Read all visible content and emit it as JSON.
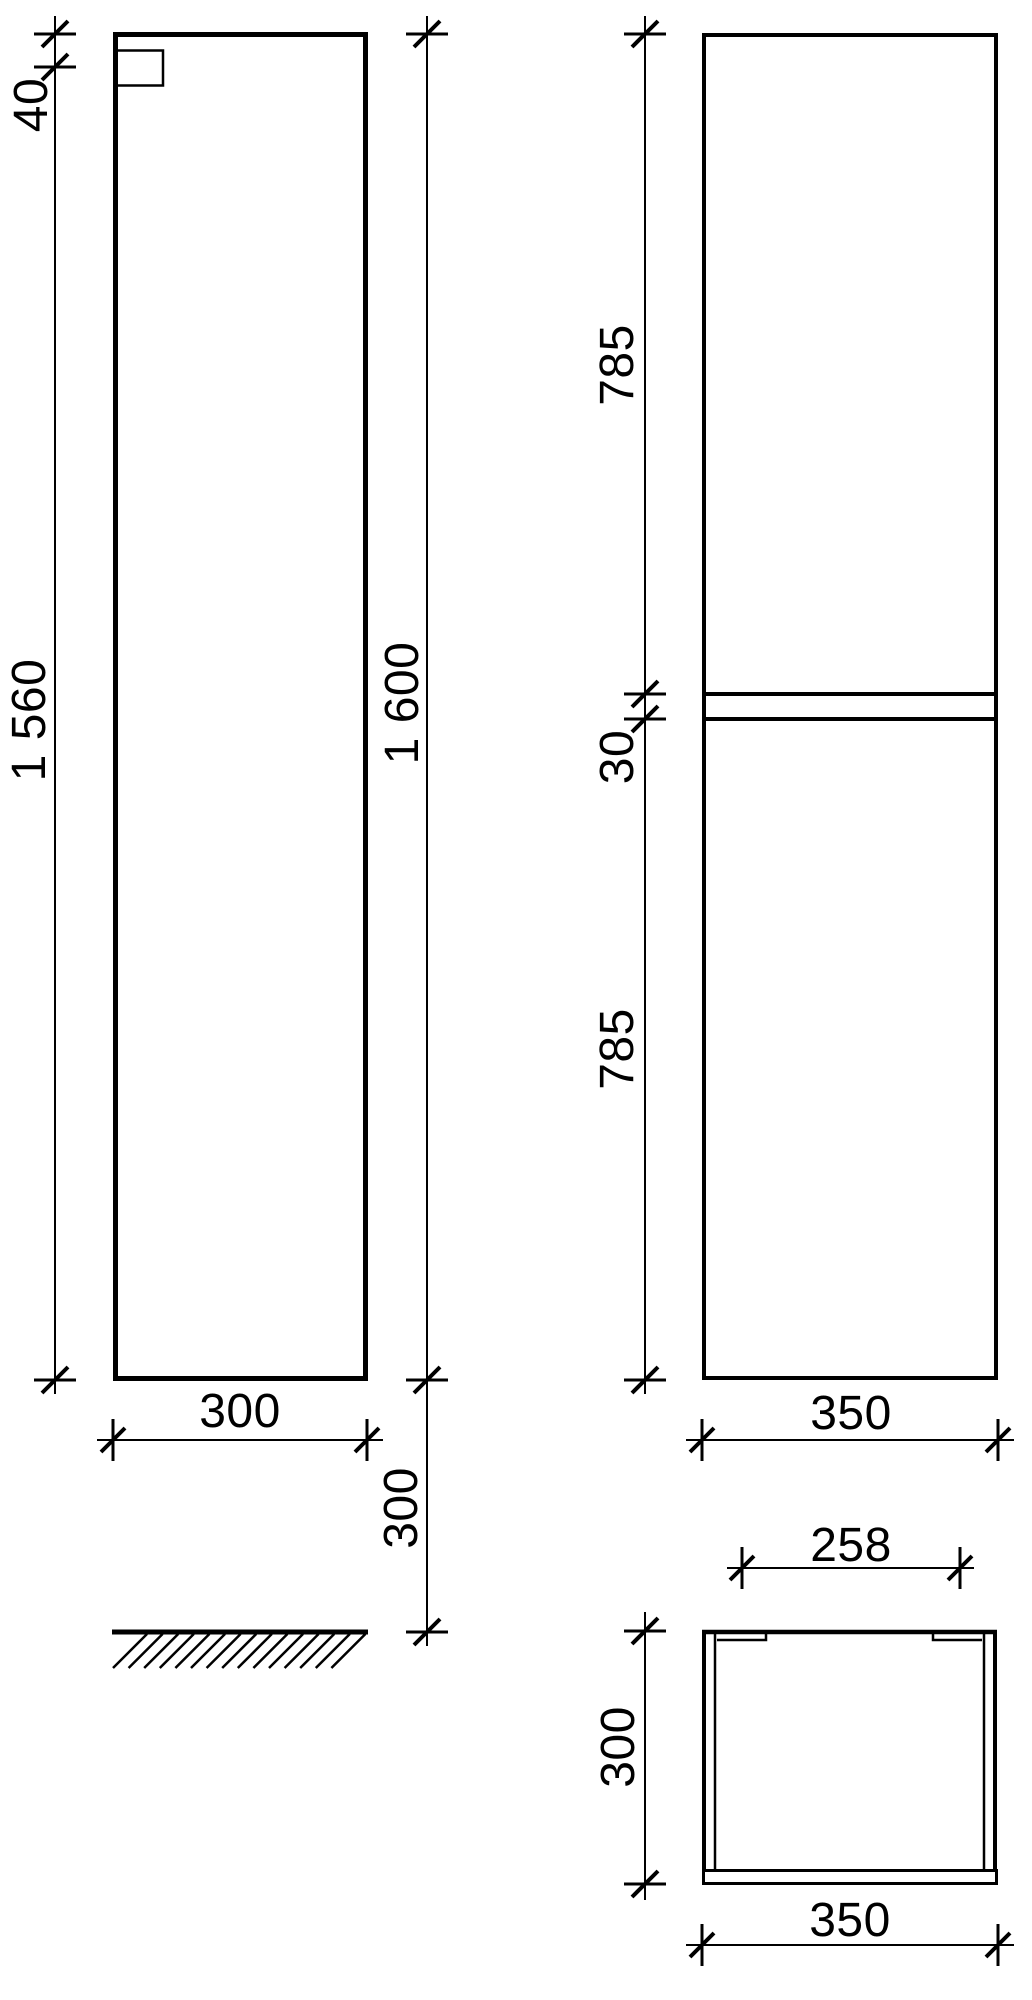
{
  "drawing": {
    "background_color": "#ffffff",
    "line_color": "#000000",
    "views": {
      "side": {
        "dims": {
          "rail_offset": "40",
          "body_height": "1 560",
          "total_height": "1 600",
          "depth": "300",
          "floor_clearance": "300"
        }
      },
      "front": {
        "dims": {
          "upper_section": "785",
          "gap": "30",
          "lower_section": "785",
          "width": "350"
        }
      },
      "top": {
        "dims": {
          "inner_width": "258",
          "depth": "300",
          "width": "350"
        }
      }
    }
  }
}
